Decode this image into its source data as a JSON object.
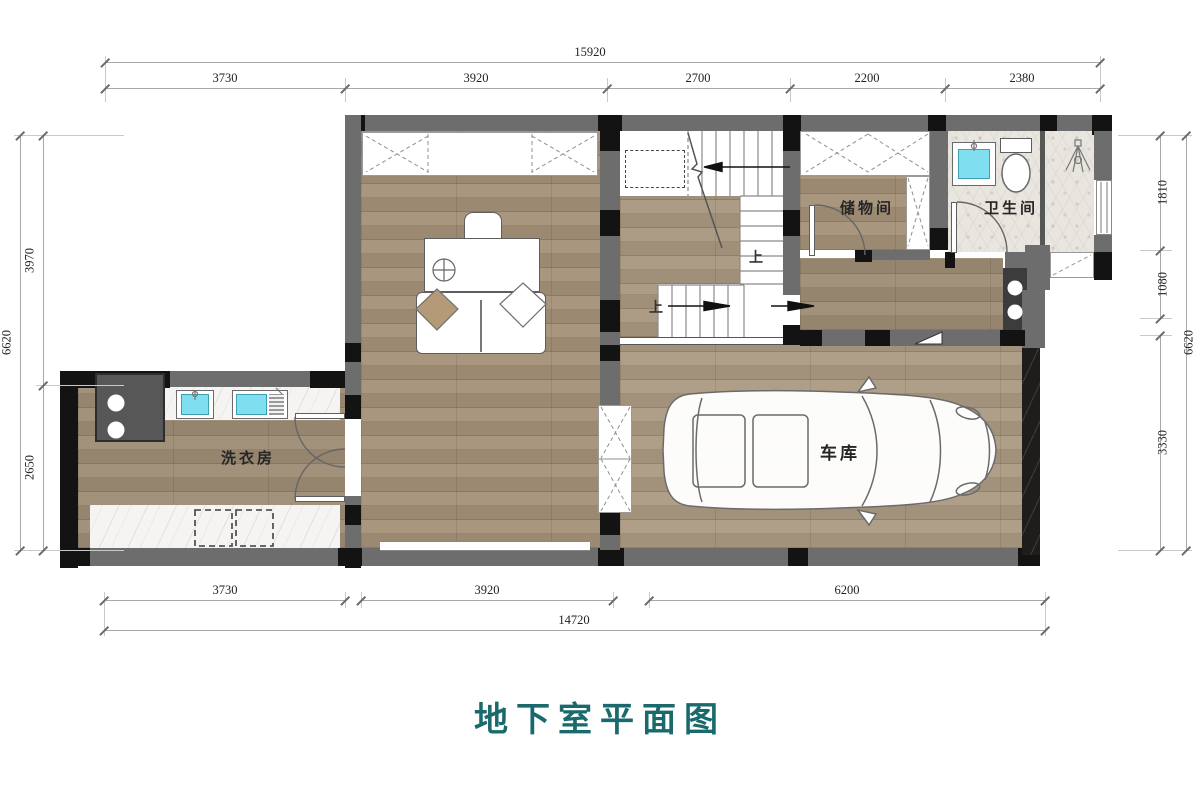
{
  "title": {
    "text": "地下室平面图"
  },
  "dimensions": {
    "top": {
      "total": "15920",
      "segments": [
        "3730",
        "3920",
        "2700",
        "2200",
        "2380"
      ]
    },
    "bottom": {
      "total": "14720",
      "segments": [
        "3730",
        "3920",
        "6200"
      ]
    },
    "left": {
      "total": "6620",
      "segments": [
        "3970",
        "2650"
      ]
    },
    "right": {
      "total": "6620",
      "segments": [
        "1810",
        "1080",
        "3330"
      ]
    }
  },
  "rooms": {
    "storage": {
      "label": "储物间"
    },
    "bathroom": {
      "label": "卫生间"
    },
    "laundry": {
      "label": "洗衣房"
    },
    "garage": {
      "label": "车库"
    }
  },
  "stairs": {
    "up1": "上",
    "up2": "上"
  },
  "colors": {
    "title_teal": "#1a6a6d",
    "wall_gray": "#6d6d6d",
    "wall_black": "#131313",
    "wood": "#a49078",
    "tile": "#e9e5df",
    "marble": "#f5f4f2",
    "fixture_blue": "#7fdef0"
  }
}
